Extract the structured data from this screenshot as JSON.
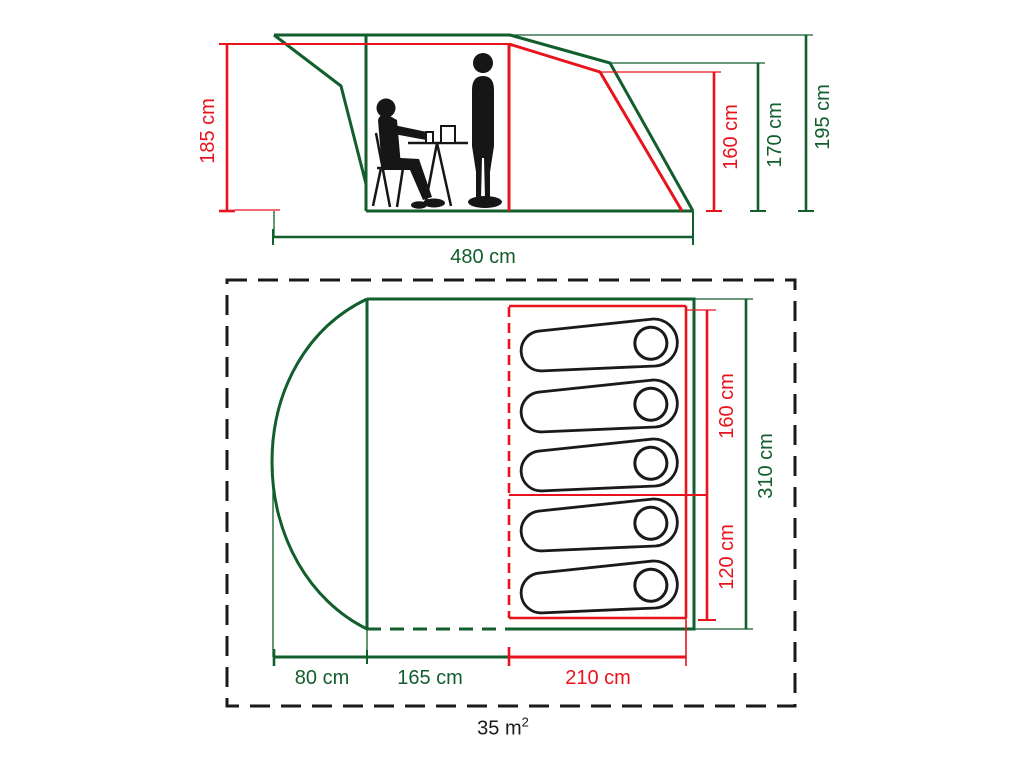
{
  "colors": {
    "accent_green": "#125e2c",
    "accent_red": "#e8131c",
    "line_black": "#1a1a1a"
  },
  "side_view": {
    "awning_height": "185 cm",
    "cabin_height": "160 cm",
    "rear_height": "170 cm",
    "peak_height": "195 cm",
    "total_length": "480 cm"
  },
  "floor_plan": {
    "sleeping_large_width": "160 cm",
    "sleeping_small_width": "120 cm",
    "total_width": "310 cm",
    "canopy_depth": "80 cm",
    "living_depth": "165 cm",
    "sleeping_depth": "210 cm",
    "total_area_value": "35 m",
    "total_area_exponent": "2"
  }
}
